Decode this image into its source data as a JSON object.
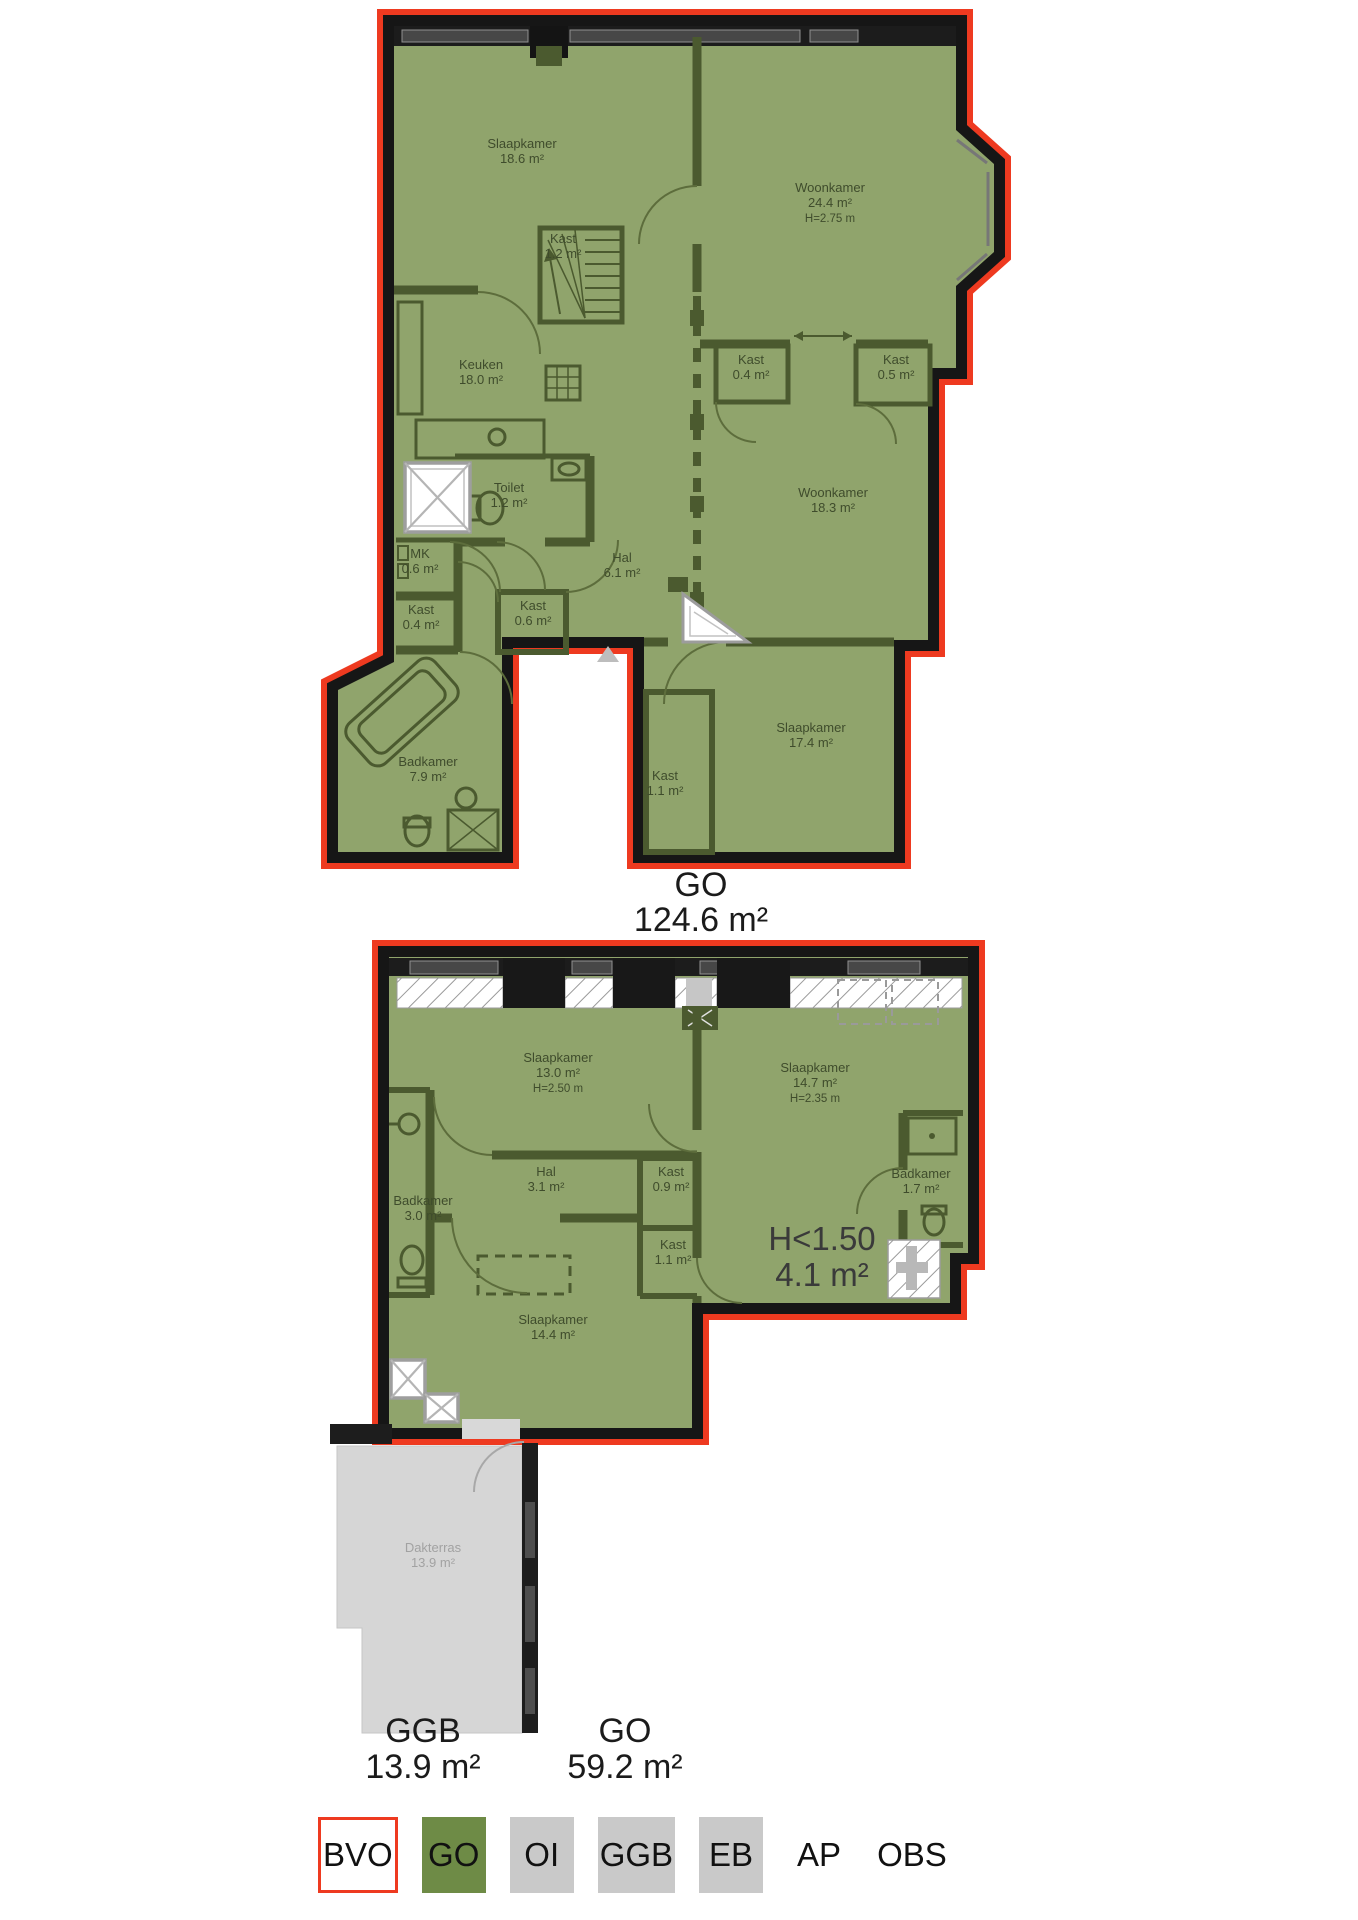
{
  "colors": {
    "bvo_red": "#ee3a20",
    "go_green_fill": "#90a46c",
    "go_green_legend": "#6e8b46",
    "wall_black": "#161616",
    "interior_wall_green": "#4b5a2f",
    "room_text_green": "#3f4c2c",
    "ggb_grey": "#d6d6d6",
    "legend_grey": "#c9c9c9",
    "label_black": "#1b1b1b"
  },
  "floor_upper": {
    "area_label": {
      "code": "GO",
      "value": "124.6 m²"
    },
    "rooms": [
      {
        "name": "Slaapkamer",
        "area": "18.6 m²",
        "x": 522,
        "y": 148
      },
      {
        "name": "Woonkamer",
        "area": "24.4 m²",
        "h": "H=2.75 m",
        "x": 830,
        "y": 192
      },
      {
        "name": "Kast",
        "area": "1.2 m²",
        "x": 563,
        "y": 243
      },
      {
        "name": "Keuken",
        "area": "18.0 m²",
        "x": 481,
        "y": 369
      },
      {
        "name": "Kast",
        "area": "0.4 m²",
        "x": 751,
        "y": 364
      },
      {
        "name": "Kast",
        "area": "0.5 m²",
        "x": 896,
        "y": 364
      },
      {
        "name": "Woonkamer",
        "area": "18.3 m²",
        "x": 833,
        "y": 497
      },
      {
        "name": "Toilet",
        "area": "1.2 m²",
        "x": 509,
        "y": 492
      },
      {
        "name": "MK",
        "area": "0.6 m²",
        "x": 420,
        "y": 558
      },
      {
        "name": "Kast",
        "area": "0.4 m²",
        "x": 421,
        "y": 614
      },
      {
        "name": "Kast",
        "area": "0.6 m²",
        "x": 533,
        "y": 610
      },
      {
        "name": "Hal",
        "area": "6.1 m²",
        "x": 622,
        "y": 562
      },
      {
        "name": "Badkamer",
        "area": "7.9 m²",
        "x": 428,
        "y": 766
      },
      {
        "name": "Kast",
        "area": "1.1 m²",
        "x": 665,
        "y": 780
      },
      {
        "name": "Slaapkamer",
        "area": "17.4 m²",
        "x": 811,
        "y": 732
      }
    ]
  },
  "floor_lower": {
    "area_label": {
      "code": "GO",
      "value": "59.2 m²"
    },
    "ggb_label": {
      "code": "GGB",
      "value": "13.9 m²"
    },
    "low_height_label": {
      "line1": "H<1.50",
      "line2": "4.1 m²"
    },
    "rooms": [
      {
        "name": "Slaapkamer",
        "area": "13.0 m²",
        "h": "H=2.50 m",
        "x": 558,
        "y": 1062
      },
      {
        "name": "Slaapkamer",
        "area": "14.7 m²",
        "h": "H=2.35 m",
        "x": 815,
        "y": 1072
      },
      {
        "name": "Badkamer",
        "area": "3.0 m²",
        "x": 423,
        "y": 1205
      },
      {
        "name": "Hal",
        "area": "3.1 m²",
        "x": 546,
        "y": 1176
      },
      {
        "name": "Kast",
        "area": "0.9 m²",
        "x": 671,
        "y": 1176
      },
      {
        "name": "Kast",
        "area": "1.1 m²",
        "x": 673,
        "y": 1249
      },
      {
        "name": "Badkamer",
        "area": "1.7 m²",
        "x": 921,
        "y": 1178
      },
      {
        "name": "Slaapkamer",
        "area": "14.4 m²",
        "x": 553,
        "y": 1324
      },
      {
        "name": "Dakterras",
        "area": "13.9 m²",
        "x": 433,
        "y": 1552,
        "muted": true
      }
    ]
  },
  "legend": {
    "items": [
      {
        "label": "BVO",
        "style": "bvo"
      },
      {
        "label": "GO",
        "style": "go"
      },
      {
        "label": "OI",
        "style": "grey"
      },
      {
        "label": "GGB",
        "style": "grey"
      },
      {
        "label": "EB",
        "style": "grey"
      },
      {
        "label": "AP",
        "style": "plain"
      },
      {
        "label": "OBS",
        "style": "plain"
      }
    ]
  }
}
